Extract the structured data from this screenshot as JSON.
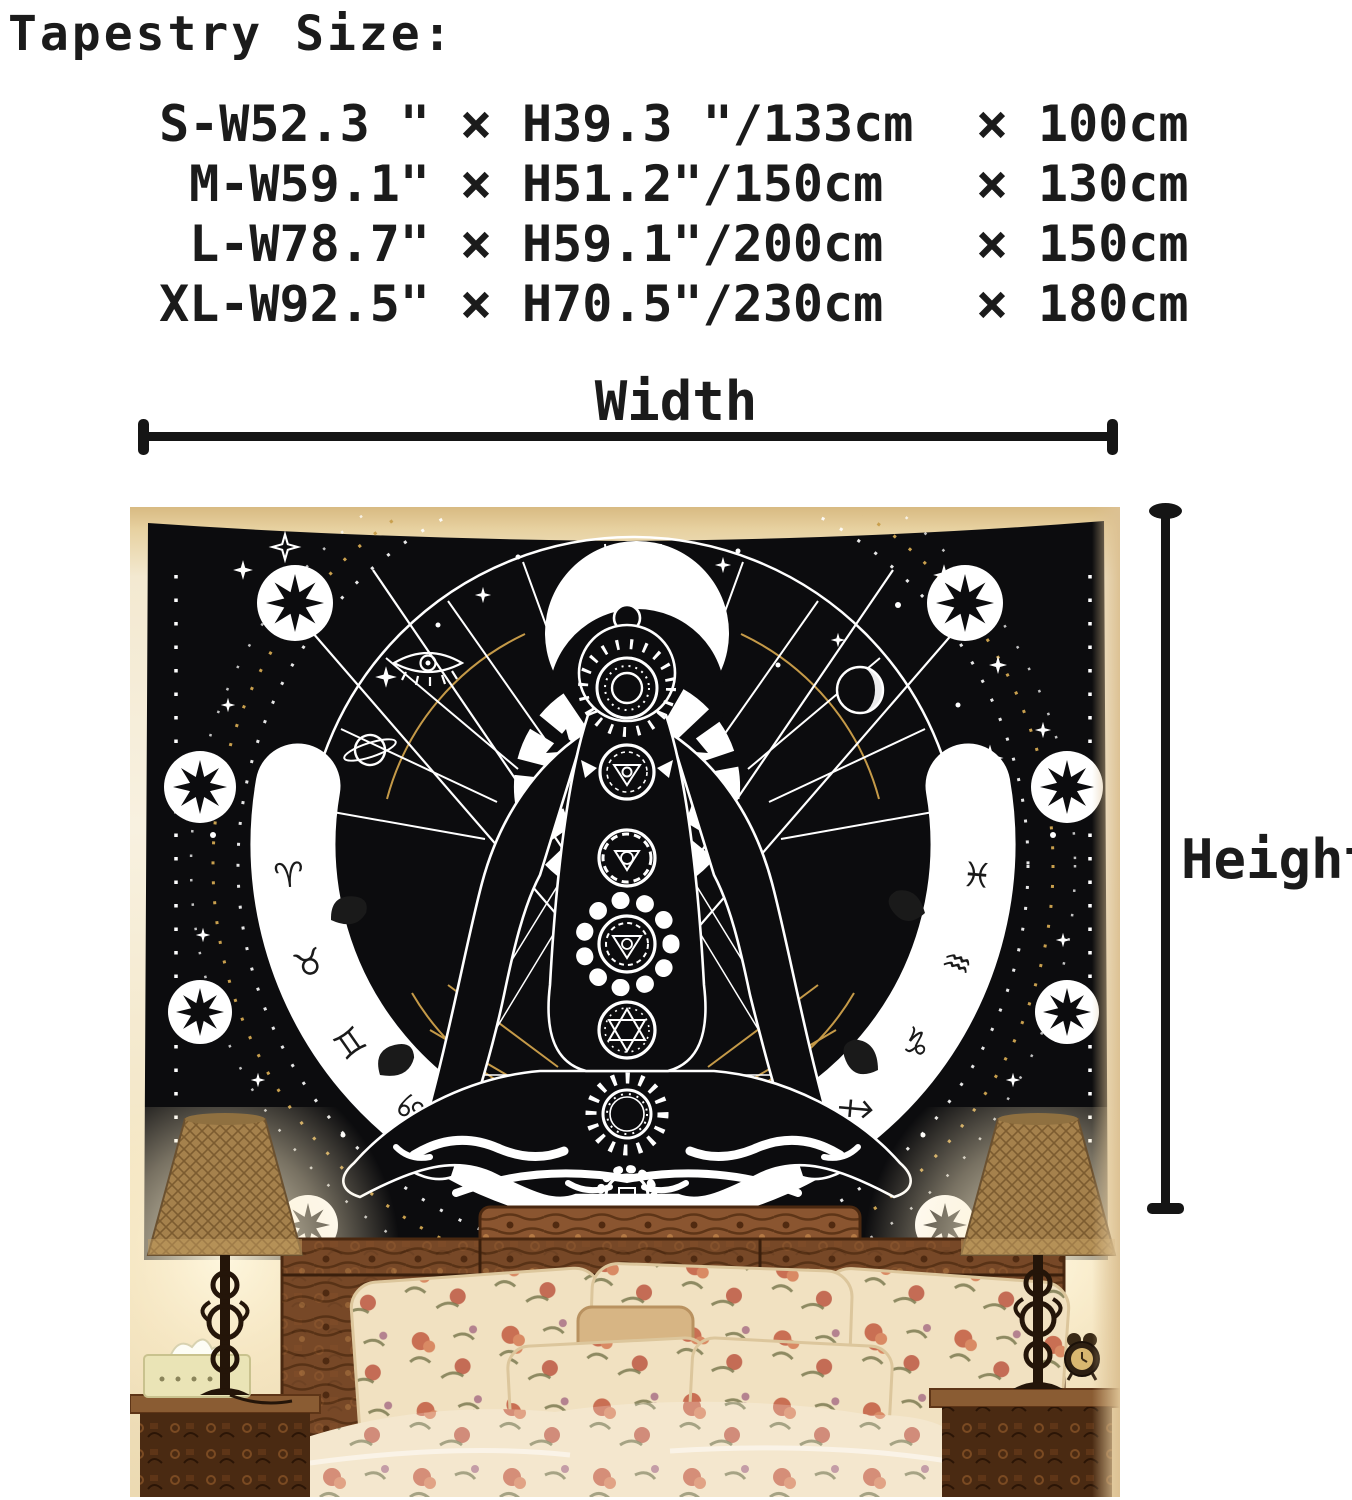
{
  "title": "Tapestry Size:",
  "size_table": {
    "rows": [
      {
        "size": "S-W52.3 \"",
        "x1": "×",
        "height": "H39.3 \"/133cm",
        "x2": "×",
        "cm": "100cm"
      },
      {
        "size": "M-W59.1\"",
        "x1": "×",
        "height": "H51.2\"/150cm",
        "x2": "×",
        "cm": "130cm"
      },
      {
        "size": "L-W78.7\"",
        "x1": "×",
        "height": "H59.1\"/200cm",
        "x2": "×",
        "cm": "150cm"
      },
      {
        "size": "XL-W92.5\"",
        "x1": "×",
        "height": "H70.5\"/230cm",
        "x2": "×",
        "cm": "180cm"
      }
    ]
  },
  "dimension_labels": {
    "width": "Width",
    "height": "Height"
  },
  "tapestry": {
    "zodiac_left": [
      "♈",
      "♉",
      "♊",
      "♋"
    ],
    "zodiac_right": [
      "♓",
      "♒",
      "♑",
      "♐"
    ],
    "colors": {
      "fabric": "#0c0c0e",
      "line_art": "#ffffff",
      "gold": "#c59a48"
    }
  },
  "photo": {
    "colors": {
      "wall": "#f3e9d1",
      "wall_top": "#dfc28e",
      "wood": "#8a5530",
      "bedding": "#f1e1c1"
    }
  }
}
